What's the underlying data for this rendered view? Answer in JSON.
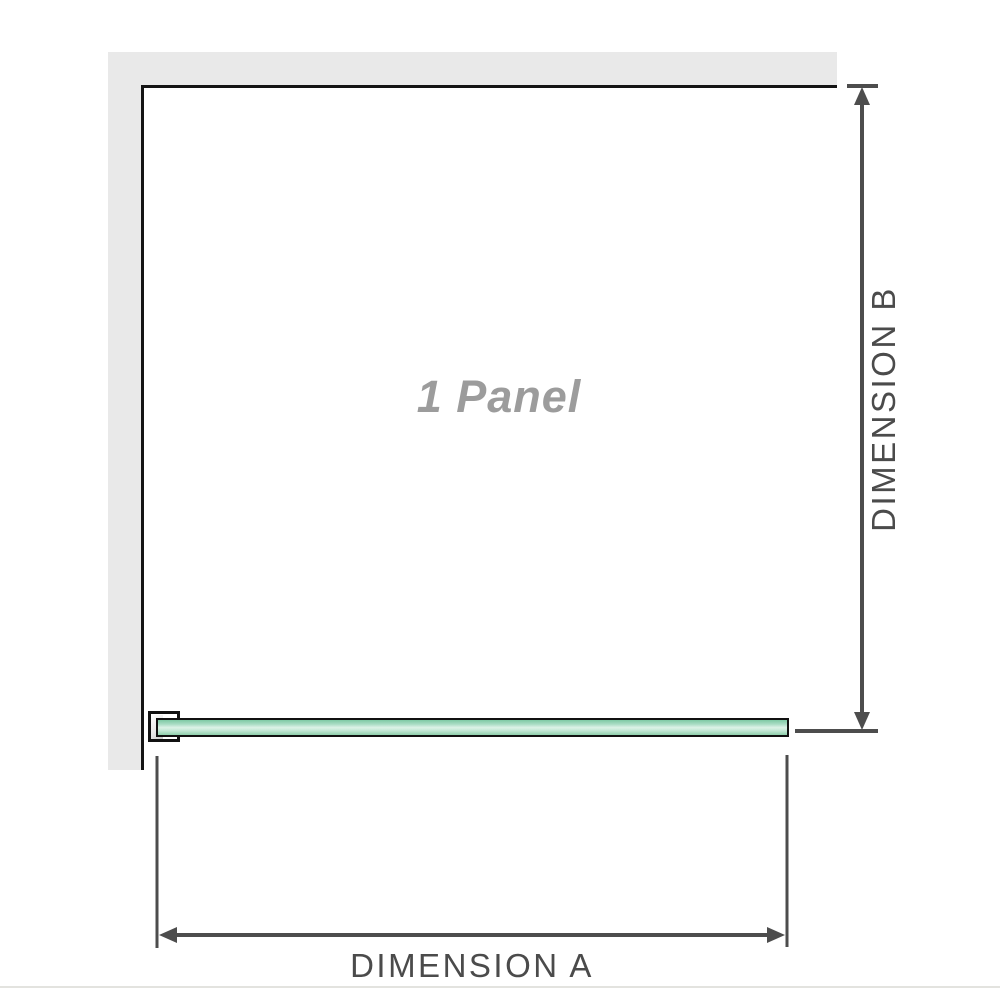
{
  "diagram": {
    "title": "Shower screen single panel dimension diagram",
    "panel_label": "1 Panel",
    "dimension_a_label": "DIMENSION A",
    "dimension_b_label": "DIMENSION B"
  },
  "colors": {
    "background": "#ffffff",
    "wall_fill": "#e9e9e9",
    "wall_edge": "#141414",
    "glass_outline": "#111111",
    "glass_green_dark": "#7ec9a4",
    "glass_green_light": "#ddf2e7",
    "bracket_outline": "#111111",
    "dimension_line": "#4d4d4d",
    "dimension_text": "#4b4b4b",
    "panel_text": "#9c9c9c",
    "footer_rule": "#e3e3df"
  },
  "icons": {
    "arrowhead_up": "▲",
    "arrowhead_down": "▼",
    "arrowhead_left": "◀",
    "arrowhead_right": "▶"
  }
}
